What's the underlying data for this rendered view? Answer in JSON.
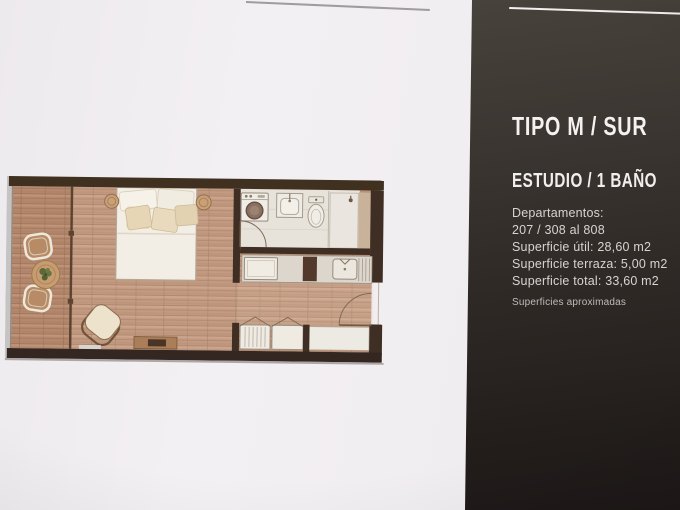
{
  "panel": {
    "title": "TIPO M / SUR",
    "subtitle": "ESTUDIO / 1 BAÑO",
    "details": [
      "Departamentos:",
      "207 / 308 al 808",
      "Superficie útil: 28,60 m2",
      "Superficie terraza: 5,00 m2",
      "Superficie total: 33,60 m2"
    ],
    "footnote": "Superficies aproximadas"
  },
  "colors": {
    "page_background": "#f1eef1",
    "panel_top": "#48423c",
    "panel_bottom": "#1d1817",
    "heading_text": "#f4f2f0",
    "body_text": "#d7d3d1",
    "plan_wall": "#3e2e23",
    "plan_wood_floor": "#bb8f72",
    "plan_bathroom_floor": "#e7e2da"
  }
}
